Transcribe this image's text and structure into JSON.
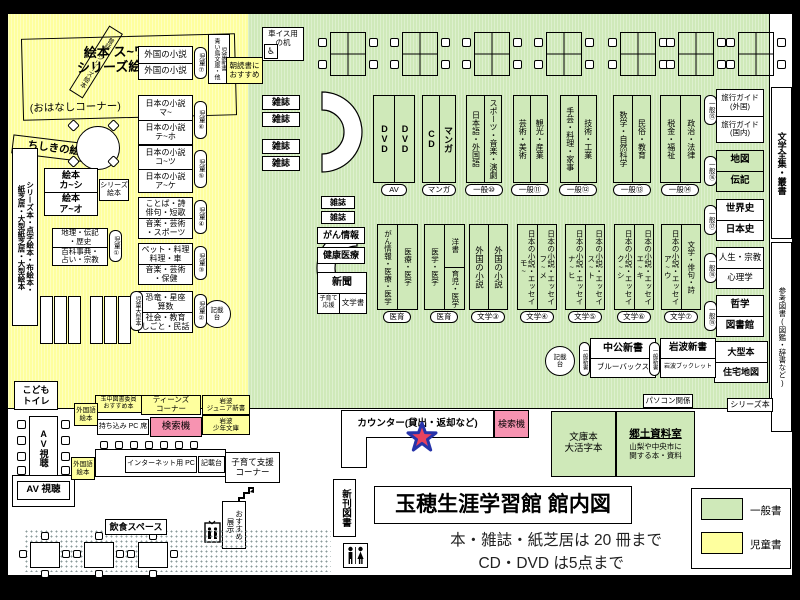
{
  "colors": {
    "general_green": "#cfe9b9",
    "children_yellow": "#feff9e",
    "search_pink": "#f793b1",
    "star_fill": "#e8425e",
    "star_outline": "#2633aa"
  },
  "title_block": {
    "title": "玉穂生涯学習館 館内図",
    "rule1": "本・雑誌・紙芝居は 20 冊まで",
    "rule2": "CD・DVD は5点まで"
  },
  "legend": {
    "general_label": "一般書",
    "children_label": "児童書"
  },
  "children_area": {
    "stage_title": "絵本 ス~ワ\nシリーズ絵本",
    "stage_subtitle": "(おはなしコーナー)",
    "stage_side_band": "昔話・シリーズ絵本",
    "knowledge_band": "ちしきの絵本",
    "left_wall": "シリーズ本・点字絵本・布絵本・\n紙芝居・大型紙芝居・大型絵本",
    "large_books_tag": "児童大型本",
    "picture_books": {
      "top": "絵本\nカ~シ",
      "bottom": "絵本\nア~オ",
      "tag": "シリーズ\n絵本"
    },
    "reference": {
      "top": "地理・伝記\n・歴史",
      "bottom": "百科事典・\n占い・宗教",
      "tag": "児童①"
    },
    "mid_shelves": [
      {
        "top": "外国の小説",
        "bottom": "外国の小説",
        "tag": "児童⑦"
      },
      {
        "top": "日本の小説\nマ~",
        "bottom": "日本の小説\nテ~ホ",
        "tag": "児童⑥"
      },
      {
        "top": "日本の小説\nコ~ツ",
        "bottom": "日本の小説\nア~ケ",
        "tag": "児童⑤"
      },
      {
        "top": "ことば・詩\n俳句・短歌",
        "bottom": "音楽・芸術\n・スポーツ",
        "tag": "児童④"
      },
      {
        "top": "ペット・料理\n料理・車",
        "bottom": "音楽・芸術\n・保健",
        "tag": "児童③"
      },
      {
        "top": "恐竜・星座\n算数",
        "bottom": "社会・教育\nしごと・民話",
        "tag": "児童②"
      }
    ],
    "writing_desk": "記載\n台",
    "kids_shinsho": "児童新書\n青い鳥文庫・他",
    "morning_reading": "朝読書に\nおすすめ",
    "kids_toilet": "こども\nトイレ"
  },
  "general_area": {
    "wheelchair_desk": "車イス用\nの机",
    "wheelchair_icon": "♿",
    "magazine": "雑誌",
    "row1_shelves": [
      {
        "left": "DVD",
        "right": "DVD",
        "tag": "AV"
      },
      {
        "left": "CD",
        "right": "マンガ",
        "tag": "マンガ"
      },
      {
        "left": "日本語・外国語",
        "right": "スポーツ・音楽・演劇",
        "tag": "一般⑩"
      },
      {
        "left": "芸術・美術",
        "right": "観光・産業",
        "tag": "一般⑪"
      },
      {
        "left": "手芸・料理・家事",
        "right": "技術・工業",
        "tag": "一般⑫"
      },
      {
        "left": "数学・自然科学",
        "right": "民俗・教育",
        "tag": "一般⑬"
      },
      {
        "left": "税金・福祉",
        "right": "政治・法律",
        "tag": "一般⑭"
      }
    ],
    "info_boxes": {
      "cancer": "がん情報",
      "health": "健康医療",
      "newspaper": "新聞",
      "parenting": "子育て\n応援",
      "literature": "文学書"
    },
    "row2_shelves": [
      {
        "left": "がん情報・医療・医学",
        "right": "医療・医学",
        "tag": "医育"
      },
      {
        "left": "医学・医学",
        "right_top": "洋書",
        "right_bottom": "育児・医学",
        "tag": "医育"
      },
      {
        "left": "外国の小説",
        "right": "外国の小説",
        "tag": "文学③"
      },
      {
        "left": "日本の小説・エッセイ\nモ~",
        "right": "日本の小説・エッセイ\nフ~メ",
        "tag": "文学④"
      },
      {
        "left": "日本の小説・エッセイ\nナ~ヒ",
        "right": "日本の小説・エッセイ\nス~ト",
        "tag": "文学⑤"
      },
      {
        "left": "日本の小説・エッセイ\nク~シ",
        "right": "日本の小説・エッセイ\nエ~キ",
        "tag": "文学⑥"
      },
      {
        "left": "日本の小説・エッセイ\nア~ウ",
        "right": "文学・俳句・詩",
        "tag": "文学⑦"
      }
    ],
    "right_shelves": [
      {
        "top": "旅行ガイド\n(外国)",
        "bottom": "旅行ガイド\n(国内)",
        "tag": "一般⑮"
      },
      {
        "top": "地図",
        "bottom": "伝記",
        "tag": "一般⑯"
      },
      {
        "top": "世界史",
        "bottom": "日本史",
        "tag": "一般⑰"
      },
      {
        "top": "人生・宗教",
        "bottom": "心理学",
        "tag": "一般⑱"
      },
      {
        "top": "哲学",
        "bottom": "図書館",
        "tag": "一般⑲"
      }
    ],
    "large_books": {
      "top": "大型本",
      "bottom": "住宅地図"
    },
    "shinsho_shelves": [
      {
        "tag": "一般新書",
        "top": "中公新書",
        "bottom": "ブルーバックス"
      },
      {
        "tag": "一般新書",
        "top": "岩波新書",
        "bottom": "岩波ブックレット"
      }
    ],
    "writing_desk": "記載\n台",
    "pc_related": "パソコン関係",
    "series_books": "シリーズ本",
    "literary_collection": "文学全集・叢書",
    "reference_books": "参考図書(図鑑・辞書など)",
    "bunko_label": "文庫本\n大活字本",
    "local_room": {
      "title": "郷土資料室",
      "desc": "山梨や中央市に\n関する本・資料"
    }
  },
  "counter": {
    "label": "カウンター(貸出・返却など)",
    "search": "検索機"
  },
  "bottom_left": {
    "av_vertical": "AV視聴",
    "av_horizontal": "AV 視聴",
    "recommend_committee": "玉中図書委員\nおすすめ本",
    "foreign_picture_books": "外国語\n絵本",
    "teens_corner": "ティーンズ\nコーナー",
    "iwanami_junior": "岩波\nジュニア新書",
    "byod_pc": "持ち込み PC 席",
    "search": "検索機",
    "iwanami_shonen": "岩波\n少年文庫",
    "internet_pc": "インターネット用 PC",
    "writing_desk": "記載台",
    "childcare_corner": "子育て支援\nコーナー",
    "recommend_display": "おすすめ\n展示",
    "eating_space": "飲食スペース",
    "new_books": "新刊図書"
  }
}
